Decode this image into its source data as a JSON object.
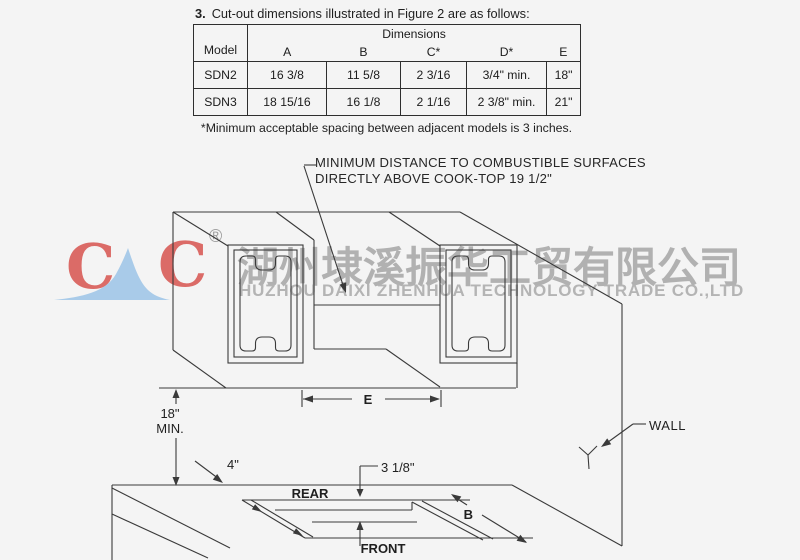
{
  "section": {
    "heading_number": "3.",
    "heading_text": "Cut-out dimensions illustrated in Figure 2 are as follows:",
    "footnote": "*Minimum acceptable spacing between adjacent models is 3 inches."
  },
  "table": {
    "model_header": "Model",
    "dimensions_header": "Dimensions",
    "columns": [
      "A",
      "B",
      "C*",
      "D*",
      "E"
    ],
    "rows": [
      {
        "model": "SDN2",
        "values": [
          "16 3/8",
          "11 5/8",
          "2 3/16",
          "3/4\" min.",
          "18\""
        ]
      },
      {
        "model": "SDN3",
        "values": [
          "18 15/16",
          "16 1/8",
          "2 1/16",
          "2 3/8\" min.",
          "21\""
        ]
      }
    ]
  },
  "diagram": {
    "note_line1": "MINIMUM DISTANCE TO COMBUSTIBLE SURFACES",
    "note_line2": "DIRECTLY ABOVE COOK-TOP 19 1/2\"",
    "labels": {
      "e": "E",
      "height_min_line1": "18\"",
      "height_min_line2": "MIN.",
      "four_inch": "4\"",
      "three_one_eighth": "3 1/8\"",
      "rear": "REAR",
      "front": "FRONT",
      "b": "B",
      "wall": "WALL"
    }
  },
  "watermark": {
    "logo_letter_left": "C",
    "logo_letter_right": "C",
    "registered_mark": "®",
    "company_cn": "湖州埭溪振华工贸有限公司",
    "company_en": "HUZHOU DAIXI ZHENHUA TECHNOLOGY TRADE CO.,LTD",
    "colors": {
      "logo_red": "#db6b67",
      "logo_blue": "#a9cbe9",
      "watermark_gray": "#b1b1b1"
    }
  }
}
